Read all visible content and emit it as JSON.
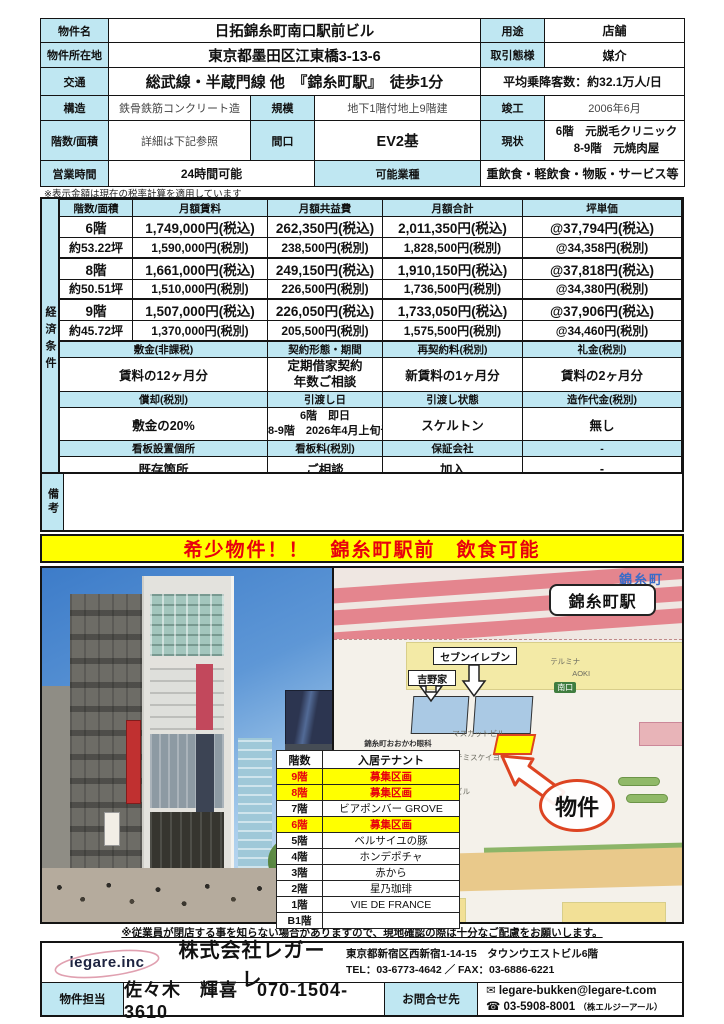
{
  "doc": {
    "name_label": "物件名",
    "name": "日拓錦糸町南口駅前ビル",
    "use_label": "用途",
    "use": "店舗",
    "address_label": "物件所在地",
    "address": "東京都墨田区江東橋3-13-6",
    "deal_label": "取引態様",
    "deal": "媒介",
    "access_label": "交通",
    "access": "総武線・半蔵門線 他　『錦糸町駅』　徒歩1分",
    "passengers": "平均乗降客数：約32.1万人/日",
    "structure_label": "構造",
    "structure": "鉄骨鉄筋コンクリート造",
    "scale_label": "規模",
    "scale": "地下1階付地上9階建",
    "built_label": "竣工",
    "built": "2006年6月",
    "floors_label": "階数/面積",
    "floors": "詳細は下記参照",
    "frontage_label": "間口",
    "frontage": "EV2基",
    "current_label": "現状",
    "current_line1": "6階　元脱毛クリニック",
    "current_line2": "8-9階　元焼肉屋",
    "hours_label": "営業時間",
    "hours": "24時間可能",
    "business_label": "可能業種",
    "business": "重飲食・軽飲食・物販・サービス等",
    "tax_note": "※表示金額は現在の税率計算を適用しています"
  },
  "econ": {
    "side_label": "経済条件",
    "headers": [
      "階数/面積",
      "月額賃料",
      "月額共益費",
      "月額合計",
      "坪単価"
    ],
    "rows": [
      [
        "6階",
        "1,749,000円(税込)",
        "262,350円(税込)",
        "2,011,350円(税込)",
        "@37,794円(税込)"
      ],
      [
        "約53.22坪",
        "1,590,000円(税別)",
        "238,500円(税別)",
        "1,828,500円(税別)",
        "@34,358円(税別)"
      ],
      [
        "8階",
        "1,661,000円(税込)",
        "249,150円(税込)",
        "1,910,150円(税込)",
        "@37,818円(税込)"
      ],
      [
        "約50.51坪",
        "1,510,000円(税別)",
        "226,500円(税別)",
        "1,736,500円(税別)",
        "@34,380円(税別)"
      ],
      [
        "9階",
        "1,507,000円(税込)",
        "226,050円(税込)",
        "1,733,050円(税込)",
        "@37,906円(税込)"
      ],
      [
        "約45.72坪",
        "1,370,000円(税別)",
        "205,500円(税別)",
        "1,575,500円(税別)",
        "@34,460円(税別)"
      ]
    ],
    "deposit_label": "敷金(非課税)",
    "deposit": "賃料の12ヶ月分",
    "contract_label": "契約形態・期間",
    "contract_line1": "定期借家契約",
    "contract_line2": "年数ご相談",
    "renewal_label": "再契約料(税別)",
    "renewal": "新賃料の1ヶ月分",
    "key_money_label": "礼金(税別)",
    "key_money": "賃料の2ヶ月分",
    "amort_label": "償却(税別)",
    "amort": "敷金の20%",
    "handover_date_label": "引渡し日",
    "handover_line1": "6階　即日",
    "handover_line2": "8-9階　2026年4月上旬予定",
    "handover_state_label": "引渡し状態",
    "handover_state": "スケルトン",
    "fixtures_label": "造作代金(税別)",
    "fixtures": "無し",
    "sign_place_label": "看板設置個所",
    "sign_place": "既存箇所",
    "sign_fee_label": "看板料(税別)",
    "sign_fee": "ご相談",
    "guarantor_label": "保証会社",
    "guarantor": "加入",
    "dash": "-",
    "remarks_label": "備考"
  },
  "banner": "希少物件！！　錦糸町駅前　飲食可能",
  "photo": {
    "storefront_sign": "星乃珈琲店"
  },
  "map": {
    "station_area": "錦糸町",
    "station_box": "錦糸町駅",
    "seven_eleven": "セブンイレブン",
    "yoshinoya": "吉野家",
    "terumina": "テルミナ",
    "aoki": "AOKI",
    "south_exit": "南口",
    "clinic": "錦糸町おおかわ眼科",
    "muscat_bldg": "マスカットビル",
    "artemis": "アルテミスケイヨー",
    "kido_bldg": "木戸ビル",
    "aoyama": "青山",
    "property_mark": "物件"
  },
  "tenants": {
    "floor_header": "階数",
    "name_header": "入居テナント",
    "rows": [
      {
        "floor": "9階",
        "name": "募集区画",
        "vacant": true
      },
      {
        "floor": "8階",
        "name": "募集区画",
        "vacant": true
      },
      {
        "floor": "7階",
        "name": "ビアポンバー GROVE",
        "vacant": false
      },
      {
        "floor": "6階",
        "name": "募集区画",
        "vacant": true
      },
      {
        "floor": "5階",
        "name": "ベルサイユの豚",
        "vacant": false
      },
      {
        "floor": "4階",
        "name": "ホンデポチャ",
        "vacant": false
      },
      {
        "floor": "3階",
        "name": "赤から",
        "vacant": false
      },
      {
        "floor": "2階",
        "name": "星乃珈琲",
        "vacant": false
      },
      {
        "floor": "1階",
        "name": "VIE DE FRANCE",
        "vacant": false
      },
      {
        "floor": "B1階",
        "name": "",
        "vacant": false
      }
    ]
  },
  "caution": "※従業員が閉店する事を知らない場合がありますので、現地確認の際は十分なご配慮をお願いします。",
  "footer": {
    "logo": "legare.inc",
    "company": "株式会社レガーレ",
    "address": "東京都新宿区西新宿1-14-15　タウンウエストビル6階",
    "tel_fax": "TEL：03-6773-4642 ／ FAX：03-6886-6221",
    "staff_label": "物件担当",
    "staff": "佐々木　輝喜　070-1504-3610",
    "contact_label": "お問合せ先",
    "email": "legare-bukken@legare-t.com",
    "phone": "03-5908-8001",
    "phone_company": "（株エルジーアール）"
  }
}
